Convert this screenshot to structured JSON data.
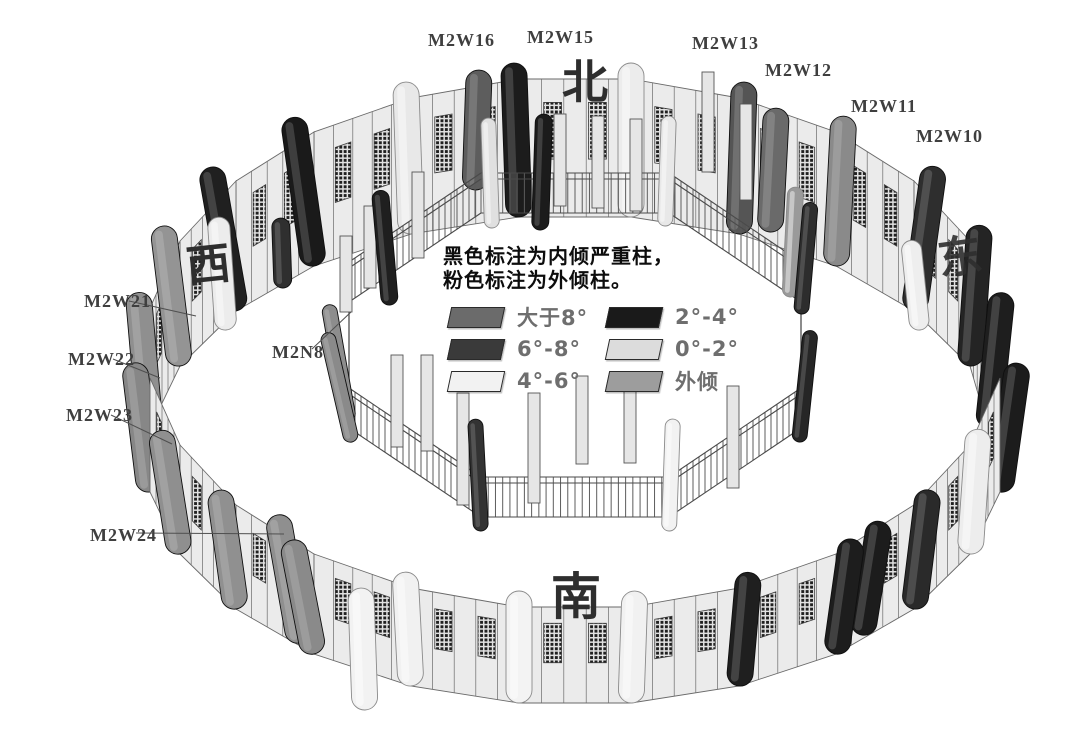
{
  "canvas": {
    "width": 1080,
    "height": 744,
    "background": "#ffffff"
  },
  "note": {
    "line1": "黑色标注为内倾严重柱，",
    "line2": "粉色标注为外倾柱。"
  },
  "legend": {
    "items": [
      {
        "label": "大于8°",
        "color": "#6b6b6b"
      },
      {
        "label": "2°-4°",
        "color": "#1a1a1a"
      },
      {
        "label": "6°-8°",
        "color": "#3a3a3a"
      },
      {
        "label": "0°-2°",
        "color": "#dcdcdc"
      },
      {
        "label": "4°-6°",
        "color": "#f2f2f2"
      },
      {
        "label": "外倾",
        "color": "#9d9d9d"
      }
    ]
  },
  "directions": {
    "north": "北",
    "south": "南",
    "west": "西",
    "east": "东"
  },
  "column_labels": [
    {
      "text": "M2W16",
      "x": 428,
      "y": 30
    },
    {
      "text": "M2W15",
      "x": 527,
      "y": 27
    },
    {
      "text": "M2W13",
      "x": 692,
      "y": 33
    },
    {
      "text": "M2W12",
      "x": 765,
      "y": 60
    },
    {
      "text": "M2W11",
      "x": 851,
      "y": 96
    },
    {
      "text": "M2W10",
      "x": 916,
      "y": 126
    },
    {
      "text": "M2W21",
      "x": 84,
      "y": 291,
      "leader": [
        129,
        301,
        196,
        316
      ]
    },
    {
      "text": "M2W22",
      "x": 68,
      "y": 349,
      "leader": [
        113,
        359,
        160,
        378
      ]
    },
    {
      "text": "M2W23",
      "x": 66,
      "y": 405,
      "leader": [
        111,
        415,
        172,
        444
      ]
    },
    {
      "text": "M2W24",
      "x": 90,
      "y": 525,
      "leader": [
        136,
        533,
        284,
        534
      ]
    },
    {
      "text": "M2N8",
      "x": 272,
      "y": 342,
      "leader": [
        312,
        349,
        351,
        312
      ]
    }
  ],
  "structure": {
    "wall_fill": "#ebebeb",
    "wall_stroke": "#6a6a6a",
    "lattice_dark": "#1f1f1f",
    "outer_col_width": 26,
    "outer_columns": [
      {
        "x": 988,
        "yt": 292,
        "yb": 428,
        "c": "#1e1e1e",
        "t": 6
      },
      {
        "x": 970,
        "yt": 225,
        "yb": 366,
        "c": "#242424",
        "t": 4
      },
      {
        "x": 914,
        "yt": 165,
        "yb": 311,
        "c": "#2e2e2e",
        "t": 8
      },
      {
        "x": 836,
        "yt": 116,
        "yb": 266,
        "c": "#8a8a8a",
        "t": 3
      },
      {
        "x": 739,
        "yt": 82,
        "yb": 234,
        "c": "#555555",
        "t": 2
      },
      {
        "x": 631,
        "yt": 63,
        "yb": 217,
        "c": "#ececec",
        "t": 0
      },
      {
        "x": 519,
        "yt": 63,
        "yb": 217,
        "c": "#1c1c1c",
        "t": -2
      },
      {
        "x": 411,
        "yt": 82,
        "yb": 234,
        "c": "#e8e8e8",
        "t": -2
      },
      {
        "x": 314,
        "yt": 116,
        "yb": 266,
        "c": "#1a1a1a",
        "t": -8
      },
      {
        "x": 236,
        "yt": 165,
        "yb": 311,
        "c": "#202020",
        "t": -10
      },
      {
        "x": 180,
        "yt": 225,
        "yb": 366,
        "c": "#949494",
        "t": -7
      },
      {
        "x": 150,
        "yt": 292,
        "yb": 428,
        "c": "#8f8f8f",
        "t": -5
      },
      {
        "x": 150,
        "yt": 362,
        "yb": 492,
        "c": "#878787",
        "t": -7
      },
      {
        "x": 180,
        "yt": 429,
        "yb": 554,
        "c": "#8f8f8f",
        "t": -9
      },
      {
        "x": 236,
        "yt": 489,
        "yb": 609,
        "c": "#909090",
        "t": -8
      },
      {
        "x": 314,
        "yt": 538,
        "yb": 654,
        "c": "#8a8a8a",
        "t": -11
      },
      {
        "x": 411,
        "yt": 572,
        "yb": 686,
        "c": "#f1f1f1",
        "t": -3
      },
      {
        "x": 519,
        "yt": 591,
        "yb": 703,
        "c": "#f3f3f3",
        "t": 0
      },
      {
        "x": 631,
        "yt": 591,
        "yb": 703,
        "c": "#f1f1f1",
        "t": 2
      },
      {
        "x": 739,
        "yt": 572,
        "yb": 686,
        "c": "#1f1f1f",
        "t": 5
      },
      {
        "x": 836,
        "yt": 538,
        "yb": 654,
        "c": "#1d1d1d",
        "t": 8
      },
      {
        "x": 914,
        "yt": 489,
        "yb": 609,
        "c": "#2a2a2a",
        "t": 7
      },
      {
        "x": 970,
        "yt": 429,
        "yb": 554,
        "c": "#ededed",
        "t": 4
      },
      {
        "x": 1000,
        "yt": 362,
        "yb": 492,
        "c": "#1c1c1c",
        "t": 8
      }
    ],
    "extra_columns": [
      {
        "x": 475,
        "yt": 70,
        "yb": 190,
        "c": "#5d5d5d",
        "t": 2
      },
      {
        "x": 770,
        "yt": 108,
        "yb": 232,
        "c": "#6a6a6a",
        "t": 3
      },
      {
        "x": 920,
        "yt": 240,
        "yb": 330,
        "c": "#eeeeee",
        "t": -6,
        "w": 20
      },
      {
        "x": 226,
        "yt": 217,
        "yb": 330,
        "c": "#ececec",
        "t": -4,
        "w": 22
      },
      {
        "x": 283,
        "yt": 218,
        "yb": 288,
        "c": "#2f2f2f",
        "t": -2,
        "w": 18
      },
      {
        "x": 300,
        "yt": 513,
        "yb": 643,
        "c": "#8f8f8f",
        "t": -10
      },
      {
        "x": 862,
        "yt": 520,
        "yb": 635,
        "c": "#1c1c1c",
        "t": 9
      },
      {
        "x": 365,
        "yt": 588,
        "yb": 710,
        "c": "#f2f2f2",
        "t": -2
      }
    ],
    "inner": {
      "vertices": [
        [
          801,
          302
        ],
        [
          669,
          213
        ],
        [
          481,
          213
        ],
        [
          349,
          302
        ],
        [
          349,
          428
        ],
        [
          481,
          517
        ],
        [
          669,
          517
        ],
        [
          801,
          428
        ]
      ],
      "fence_h": 40,
      "col_width": 15,
      "columns": [
        {
          "x": 801,
          "yt": 202,
          "yb": 314,
          "c": "#2d2d2d",
          "t": 5
        },
        {
          "x": 665,
          "yt": 116,
          "yb": 226,
          "c": "#e8e8e8",
          "t": 2
        },
        {
          "x": 492,
          "yt": 118,
          "yb": 228,
          "c": "#e0e0e0",
          "t": -2
        },
        {
          "x": 349,
          "yt": 303,
          "yb": 421,
          "c": "#8d8d8d",
          "t": -10
        },
        {
          "x": 352,
          "yt": 330,
          "yb": 442,
          "c": "#8a8a8a",
          "t": -13
        },
        {
          "x": 481,
          "yt": 419,
          "yb": 531,
          "c": "#333333",
          "t": -3
        },
        {
          "x": 669,
          "yt": 419,
          "yb": 531,
          "c": "#f2f2f2",
          "t": 2
        },
        {
          "x": 799,
          "yt": 330,
          "yb": 442,
          "c": "#262626",
          "t": 6
        }
      ],
      "extra_columns": [
        {
          "x": 540,
          "yt": 114,
          "yb": 230,
          "c": "#1b1b1b",
          "t": 2,
          "w": 17
        },
        {
          "x": 390,
          "yt": 190,
          "yb": 305,
          "c": "#1f1f1f",
          "t": -5,
          "w": 17
        },
        {
          "x": 790,
          "yt": 187,
          "yb": 297,
          "c": "#9a9a9a",
          "t": 3,
          "w": 16
        }
      ],
      "balusters_back": [
        [
          560,
          206,
          92
        ],
        [
          598,
          208,
          92
        ],
        [
          636,
          211,
          92
        ],
        [
          708,
          172,
          100
        ],
        [
          746,
          200,
          96
        ],
        [
          418,
          258,
          86
        ],
        [
          370,
          288,
          82
        ],
        [
          346,
          312,
          76
        ]
      ],
      "balusters_front": [
        [
          397,
          447,
          92
        ],
        [
          427,
          451,
          96
        ],
        [
          463,
          505,
          112
        ],
        [
          534,
          503,
          110
        ],
        [
          582,
          464,
          88
        ],
        [
          630,
          463,
          88
        ],
        [
          733,
          488,
          102
        ]
      ]
    }
  }
}
